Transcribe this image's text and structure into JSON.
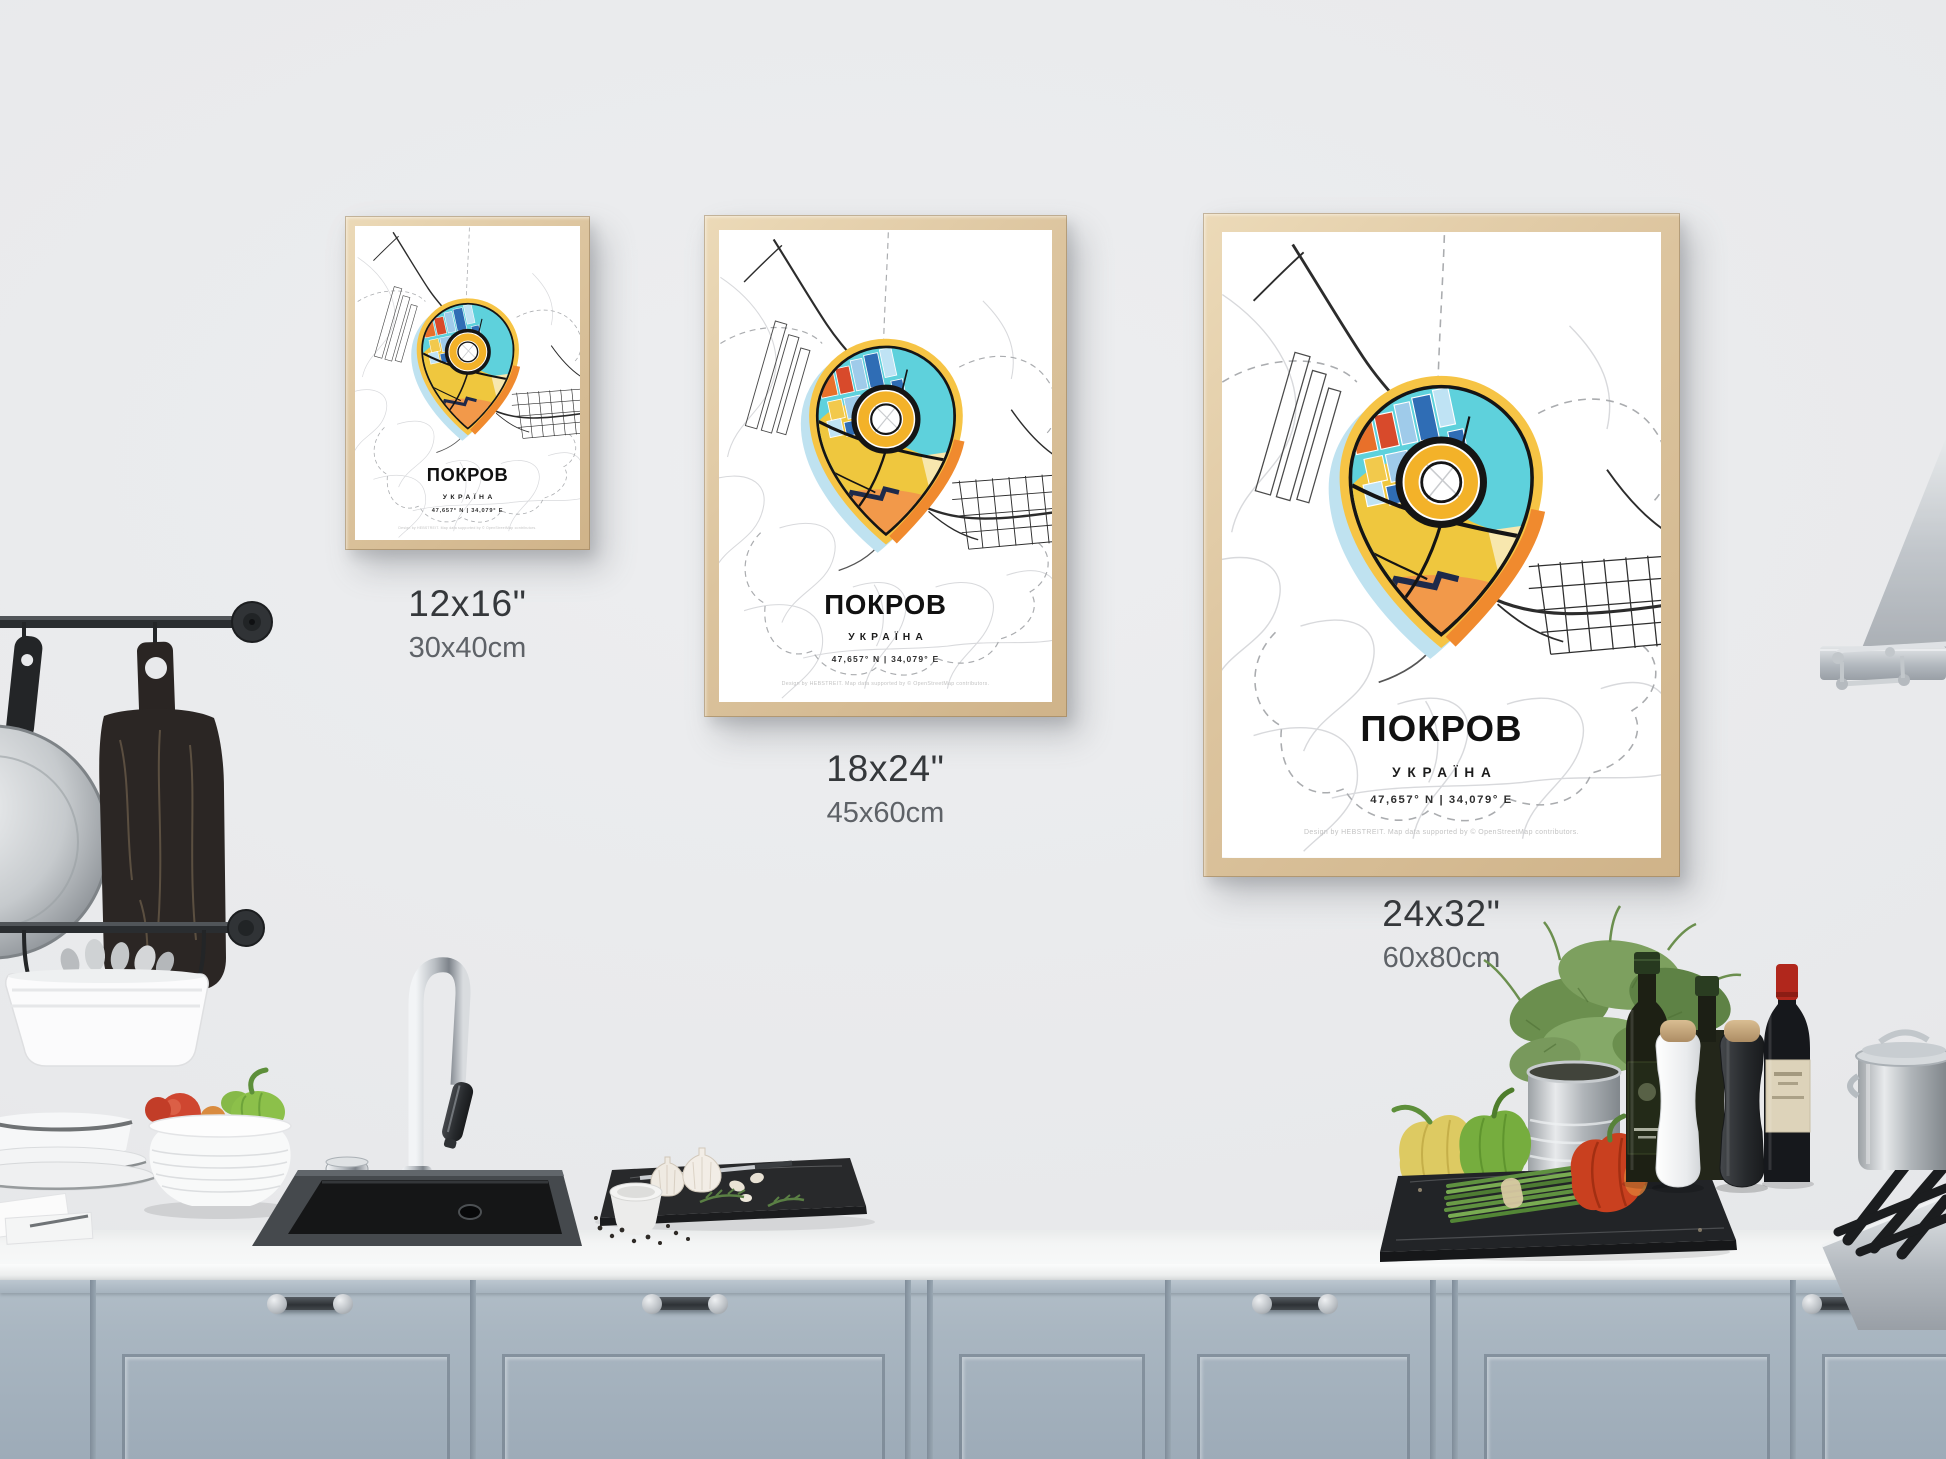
{
  "poster": {
    "title": "ПОКРОВ",
    "subtitle": "УКРАЇНА",
    "coordinates": "47,657° N | 34,079° E",
    "credit": "Design by HEBSTREIT. Map data supported by © OpenStreetMap contributors."
  },
  "variants": [
    {
      "id": "small",
      "size_in": "12x16\"",
      "size_cm": "30x40cm"
    },
    {
      "id": "medium",
      "size_in": "18x24\"",
      "size_cm": "45x60cm"
    },
    {
      "id": "large",
      "size_in": "24x32\"",
      "size_cm": "60x80cm"
    }
  ],
  "map_pin": {
    "ring_color": "#f6c445",
    "ring_accent_color": "#f08a2e",
    "shadow_color": "#bfe2f0",
    "water_color": "#5ed1dc",
    "land_color": "#efc73e",
    "lowland_color": "#f2994a",
    "outline_color": "#151515",
    "donut_ring_color": "#f3b229"
  },
  "scene_colors": {
    "wall": "#e8e9eb",
    "counter": "#f4f5f5",
    "cabinets": "#a9b6c1",
    "frame_wood": "#dcc49e"
  }
}
